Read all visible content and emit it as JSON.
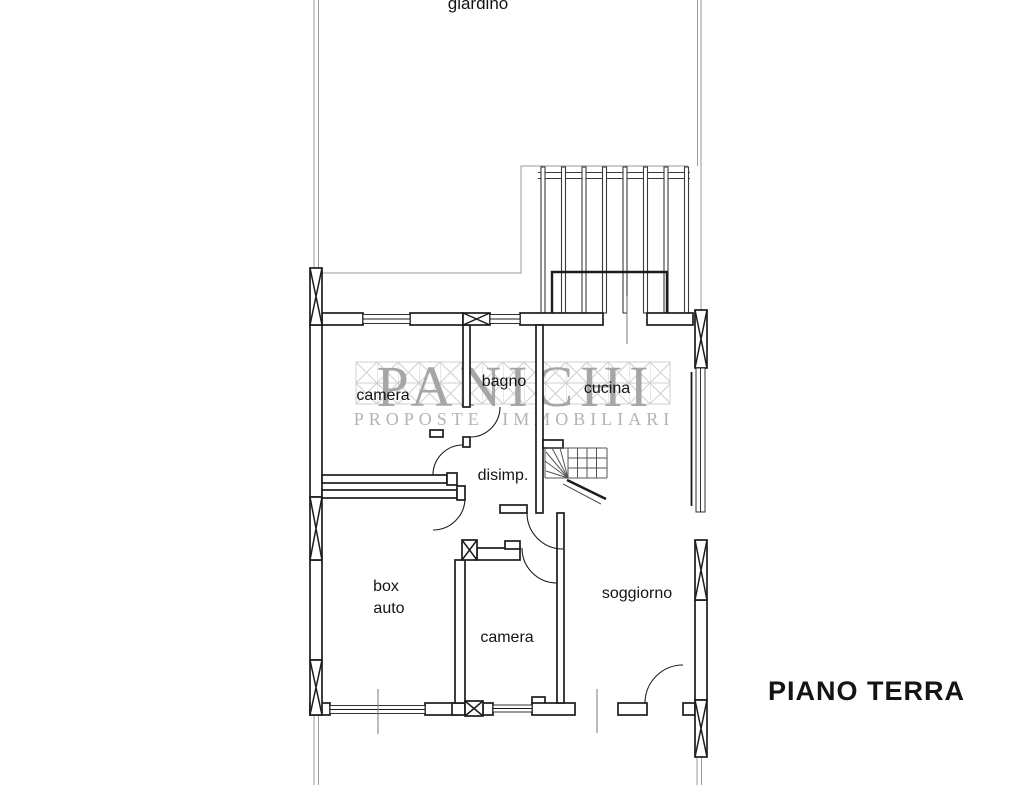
{
  "plan": {
    "title": "PIANO TERRA",
    "rooms": {
      "giardino": "giardino",
      "camera_top": "camera",
      "bagno": "bagno",
      "cucina": "cucina",
      "disimp": "disimp.",
      "box_auto_line1": "box",
      "box_auto_line2": "auto",
      "camera_bottom": "camera",
      "soggiorno": "soggiorno"
    }
  },
  "watermark": {
    "brand": "PANICHI",
    "tagline": "PROPOSTE IMMOBILIARI"
  },
  "colors": {
    "line": "#1c1c1c",
    "boundary": "#9a9a9a",
    "watermark": "#a6a6a6",
    "watermark2": "#b3b3b3",
    "lattice": "#cfcfcf",
    "background": "#ffffff"
  }
}
